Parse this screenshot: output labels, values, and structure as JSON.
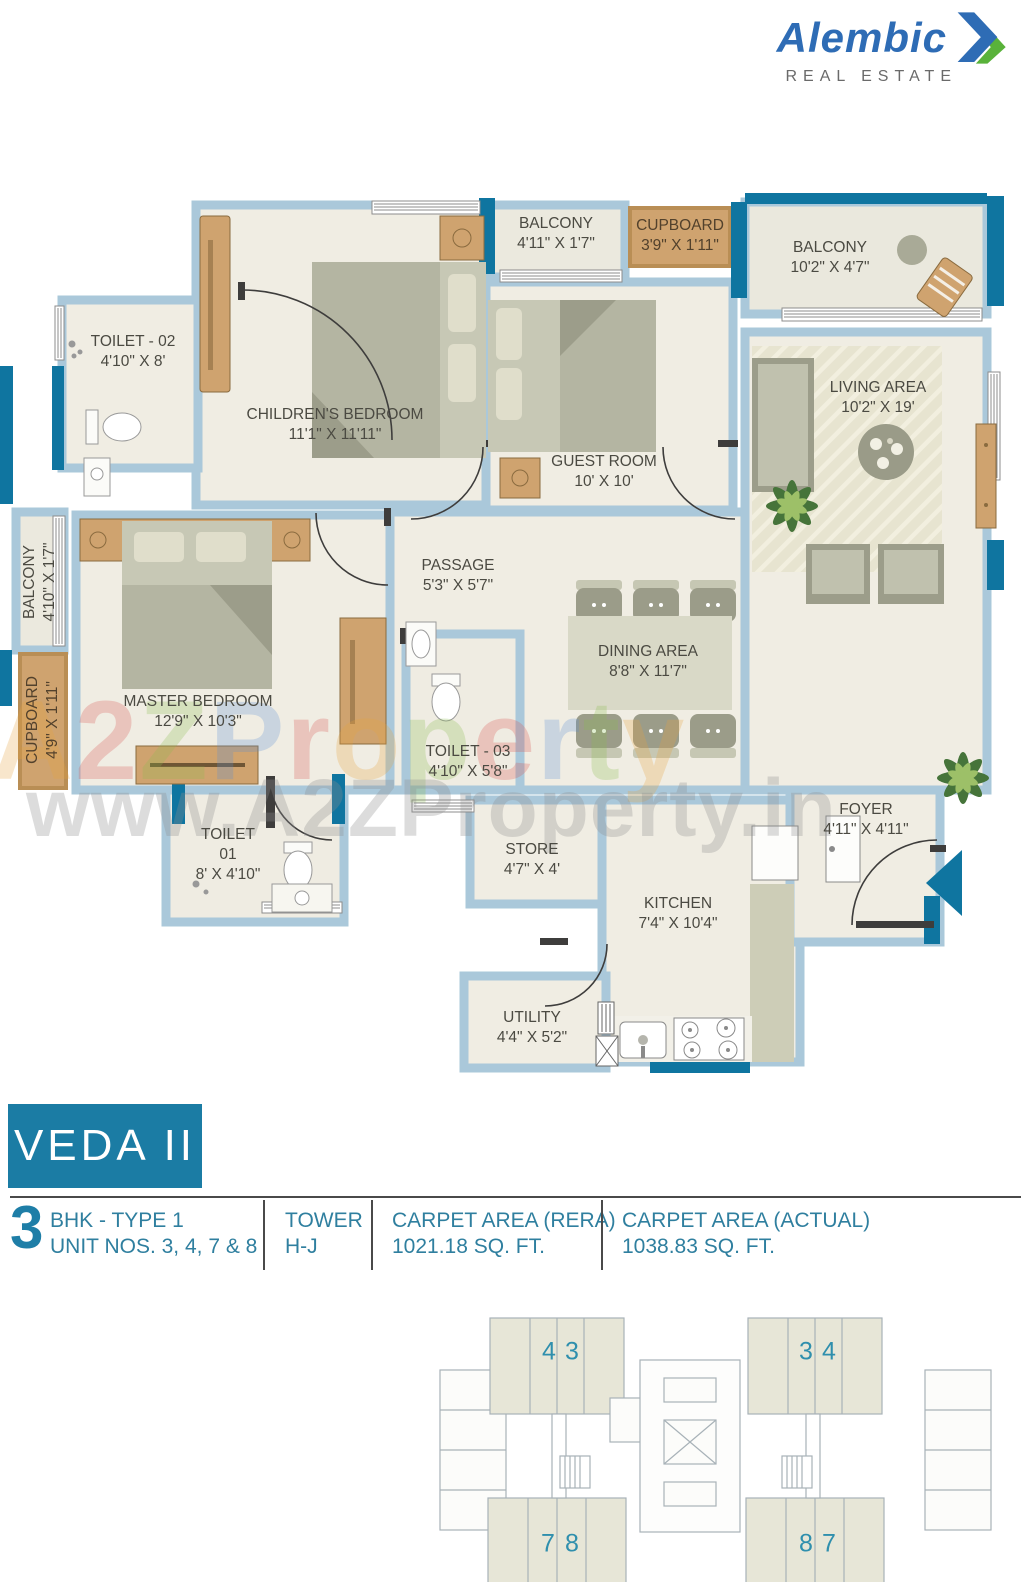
{
  "brand": {
    "name": "Alembic",
    "tagline": "REAL ESTATE"
  },
  "title": "VEDA II",
  "watermark": {
    "line1": "A2ZProperty",
    "letters": [
      "A",
      "2",
      "Z",
      "P",
      "r",
      "o",
      "p",
      "e",
      "r",
      "t",
      "y"
    ],
    "letter_colors": [
      "#e8a33d",
      "#d9534f",
      "#8bbd4f",
      "#5b8fd4",
      "#d9534f",
      "#e8a33d",
      "#8bbd4f",
      "#d9534f",
      "#5b8fd4",
      "#8bbd4f",
      "#e8a33d"
    ],
    "line2": "www.A2ZProperty.in"
  },
  "colors": {
    "accent_teal": "#1b7ca4",
    "wall_blue": "#aac8da",
    "wall_teal": "#0f75a0",
    "floor": "#f0ede3"
  },
  "plan": {
    "rooms": [
      {
        "name": "BALCONY",
        "dims": "4'11\" X 1'7\""
      },
      {
        "name": "CUPBOARD",
        "dims": "3'9\" X 1'11\""
      },
      {
        "name": "BALCONY",
        "dims": "10'2\" X 4'7\""
      },
      {
        "name": "TOILET - 02",
        "dims": "4'10\" X 8'"
      },
      {
        "name": "CHILDREN'S BEDROOM",
        "dims": "11'1\" X 11'11\""
      },
      {
        "name": "GUEST ROOM",
        "dims": "10' X 10'"
      },
      {
        "name": "LIVING AREA",
        "dims": "10'2\" X 19'"
      },
      {
        "name": "BALCONY",
        "dims": "4'10\" X 1'7\""
      },
      {
        "name": "PASSAGE",
        "dims": "5'3\" X 5'7\""
      },
      {
        "name": "DINING AREA",
        "dims": "8'8\" X 11'7\""
      },
      {
        "name": "CUPBOARD",
        "dims": "4'9\" X 1'11\""
      },
      {
        "name": "MASTER BEDROOM",
        "dims": "12'9\" X 10'3\""
      },
      {
        "name": "TOILET - 03",
        "dims": "4'10\" X 5'8\""
      },
      {
        "name": "TOILET",
        "name2": "01",
        "dims": "8' X 4'10\""
      },
      {
        "name": "STORE",
        "dims": "4'7\" X 4'"
      },
      {
        "name": "FOYER",
        "dims": "4'11\" X 4'11\""
      },
      {
        "name": "KITCHEN",
        "dims": "7'4\" X 10'4\""
      },
      {
        "name": "UTILITY",
        "dims": "4'4\" X 5'2\""
      }
    ]
  },
  "info": {
    "bhk_number": "3",
    "bhk_label": "BHK - TYPE 1",
    "unit_label": "UNIT NOS. 3, 4, 7 & 8",
    "tower_label": "TOWER",
    "tower_value": "H-J",
    "rera_label": "CARPET AREA (RERA)",
    "rera_value": "1021.18 SQ. FT.",
    "actual_label": "CARPET AREA (ACTUAL)",
    "actual_value": "1038.83 SQ. FT."
  },
  "keyplan": {
    "left": {
      "top": [
        "4",
        "3"
      ],
      "bottom": [
        "7",
        "8"
      ]
    },
    "right": {
      "top": [
        "3",
        "4"
      ],
      "bottom": [
        "8",
        "7"
      ]
    }
  }
}
